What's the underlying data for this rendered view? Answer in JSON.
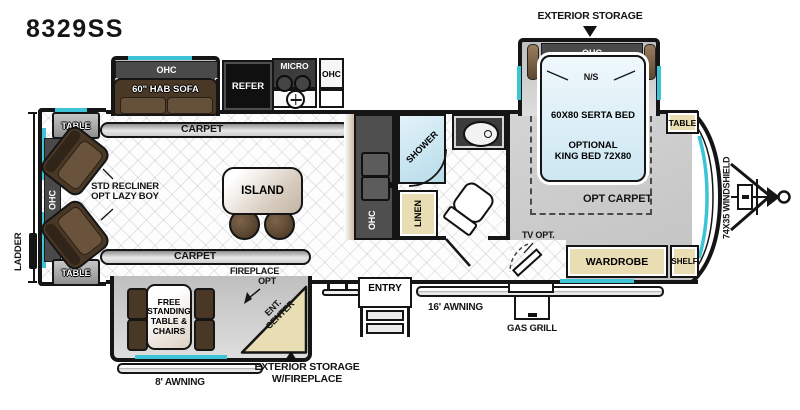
{
  "model": "8329SS",
  "colors": {
    "accent_teal": "#3cc3d6",
    "wall_black": "#151515",
    "carpet_gray": "#c9c9c9",
    "cabinet_tan": "#e9ddb3",
    "bed_blue": "#d9edf6",
    "upholstery_brown": "#4a3827",
    "dark_cabinet": "#4a4a4a"
  },
  "exterior": {
    "storage_top": "EXTERIOR STORAGE",
    "storage_bottom": "EXTERIOR STORAGE\nW/FIREPLACE",
    "awning_16": "16' AWNING",
    "awning_8": "8' AWNING",
    "gas_grill": "GAS GRILL",
    "ladder": "LADDER",
    "entry": "ENTRY",
    "windshield": "74X35 WINDSHIELD"
  },
  "living_room": {
    "ohc_sofa": "OHC",
    "sofa": "60\" HAB SOFA",
    "table_top": "TABLE",
    "table_bottom": "TABLE",
    "ohc_rear": "OHC",
    "recliners": "STD RECLINER\nOPT LAZY BOY",
    "carpet_top": "CARPET",
    "carpet_bottom": "CARPET",
    "island": "ISLAND"
  },
  "kitchen": {
    "refer": "REFER",
    "micro": "MICRO",
    "ohc_upper": "OHC",
    "ohc_galley": "OHC"
  },
  "bathroom": {
    "shower": "SHOWER",
    "linen": "LINEN"
  },
  "bedroom": {
    "ohc": "OHC",
    "night_stands": "N/S",
    "bed": "60X80 SERTA BED",
    "bed_option": "OPTIONAL\nKING BED 72X80",
    "opt_carpet": "OPT CARPET",
    "tv": "TV OPT.",
    "wardrobe": "WARDROBE",
    "shelf": "SHELF",
    "table": "TABLE"
  },
  "dinette": {
    "fireplace": "FIREPLACE\nOPT",
    "table": "FREE\nSTANDING\nTABLE &\nCHAIRS",
    "ent_center": "ENT.\nCENTER"
  }
}
